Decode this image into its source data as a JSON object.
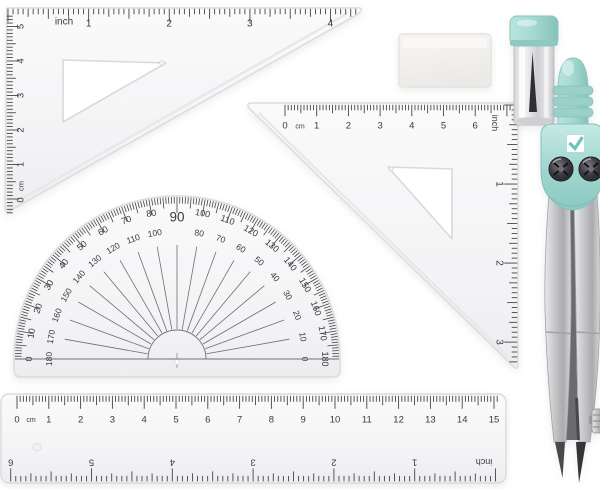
{
  "scene": {
    "description": "geometry drawing set on white background"
  },
  "colors": {
    "plastic": "#f4f4f6",
    "plastic_edge": "#dbdbde",
    "tick": "#454548",
    "mint": "#a5d8d2",
    "mint_light": "#c2e8e3",
    "mint_dark": "#8bc9c2",
    "silver": "#c6c6c9",
    "screw_dark": "#2b2b2e",
    "lead_dark": "#2f2f31",
    "white": "#ffffff"
  },
  "triangle_large": {
    "top_unit": "inch",
    "top_numbers": [
      "1",
      "2",
      "3",
      "4"
    ],
    "side_origin": "0",
    "side_unit": "cm",
    "side_numbers": [
      "1",
      "2",
      "3",
      "4",
      "5"
    ]
  },
  "triangle_small": {
    "top_origin": "0",
    "top_unit": "cm",
    "top_numbers": [
      "1",
      "2",
      "3",
      "4",
      "5",
      "6"
    ],
    "side_unit": "inch",
    "side_numbers": [
      "1",
      "2",
      "3"
    ]
  },
  "protractor": {
    "outer_labels": [
      "0",
      "10",
      "20",
      "30",
      "40",
      "50",
      "60",
      "70",
      "80",
      "90",
      "100",
      "110",
      "120",
      "130",
      "140",
      "150",
      "160",
      "170",
      "180"
    ],
    "inner_labels": [
      "180",
      "170",
      "160",
      "150",
      "140",
      "130",
      "120",
      "110",
      "100",
      "",
      "80",
      "70",
      "60",
      "50",
      "40",
      "30",
      "20",
      "10",
      "0"
    ]
  },
  "ruler": {
    "cm_origin": "0",
    "cm_unit": "cm",
    "cm_numbers": [
      "1",
      "2",
      "3",
      "4",
      "5",
      "6",
      "7",
      "8",
      "9",
      "10",
      "11",
      "12",
      "13",
      "14",
      "15"
    ],
    "inch_unit": "inch",
    "inch_numbers": [
      "1",
      "2",
      "3",
      "4",
      "5",
      "6"
    ]
  }
}
